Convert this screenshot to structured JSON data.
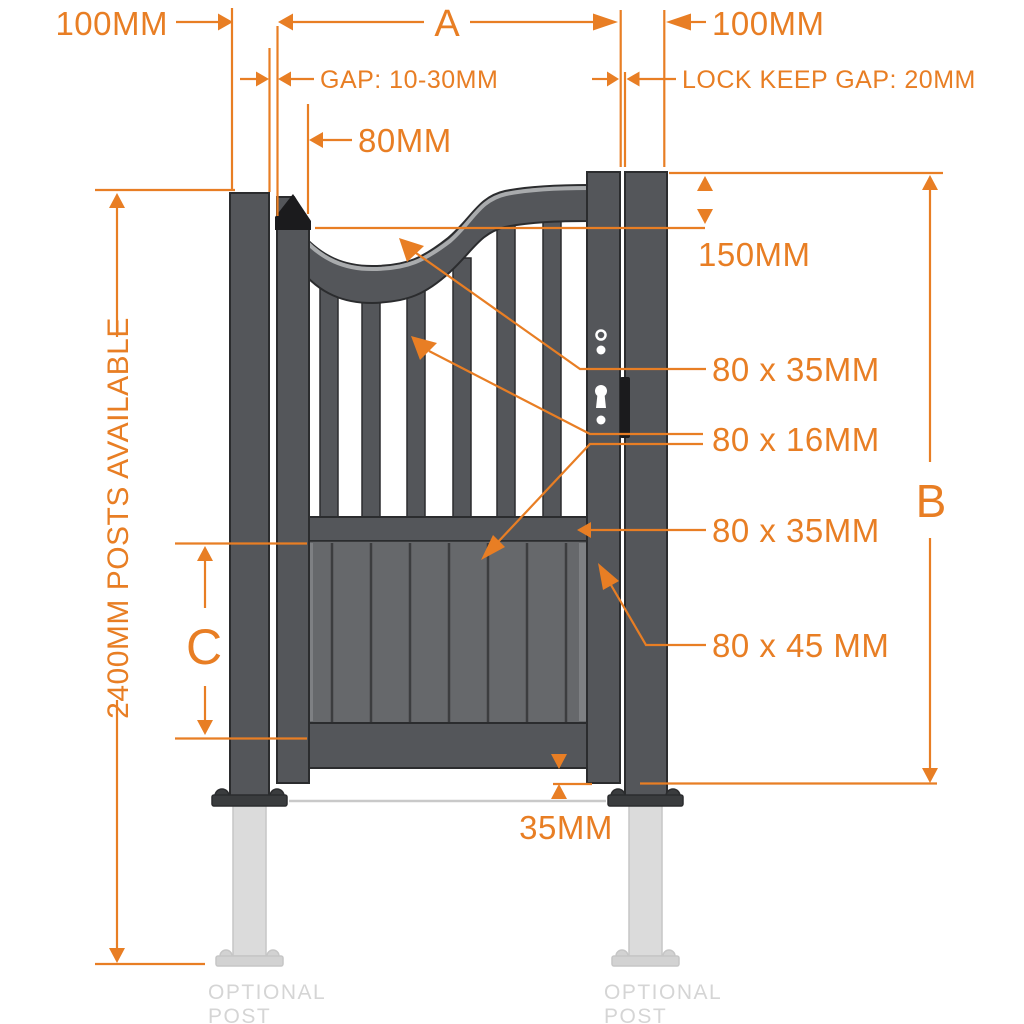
{
  "colors": {
    "accent": "#E87E24",
    "frame": "#54565A",
    "outline": "#2B2C2E",
    "panel": "#66686B",
    "panelLine": "#3C3D3F",
    "cap": "#1B1B1D",
    "flange": "#3A3C3E",
    "railHighlight": "#A9ABAD",
    "optPost": "#DBDBDB",
    "optEdge": "#C6C6C6",
    "optFlange": "#D2D2D2",
    "optText": "#D5D5D5",
    "ground": "#C9C9C9"
  },
  "labels": {
    "left_post_width": "100MM",
    "gate_width_letter": "A",
    "right_post_width": "100MM",
    "hinge_gap": "GAP: 10-30MM",
    "lock_keep_gap": "LOCK KEEP GAP: 20MM",
    "hinge_stile_width": "80MM",
    "stile_rise": "150MM",
    "top_rail_size": "80 x 35MM",
    "infill_bar_size": "80 x 16MM",
    "mid_rail_size": "80 x 35MM",
    "stile_size": "80 x 45 MM",
    "gate_height_letter": "B",
    "panel_height_letter": "C",
    "posts_available": "2400MM POSTS AVAILABLE",
    "stile_bottom_drop": "35MM",
    "optional_post_line1": "OPTIONAL",
    "optional_post_line2": "POST"
  }
}
